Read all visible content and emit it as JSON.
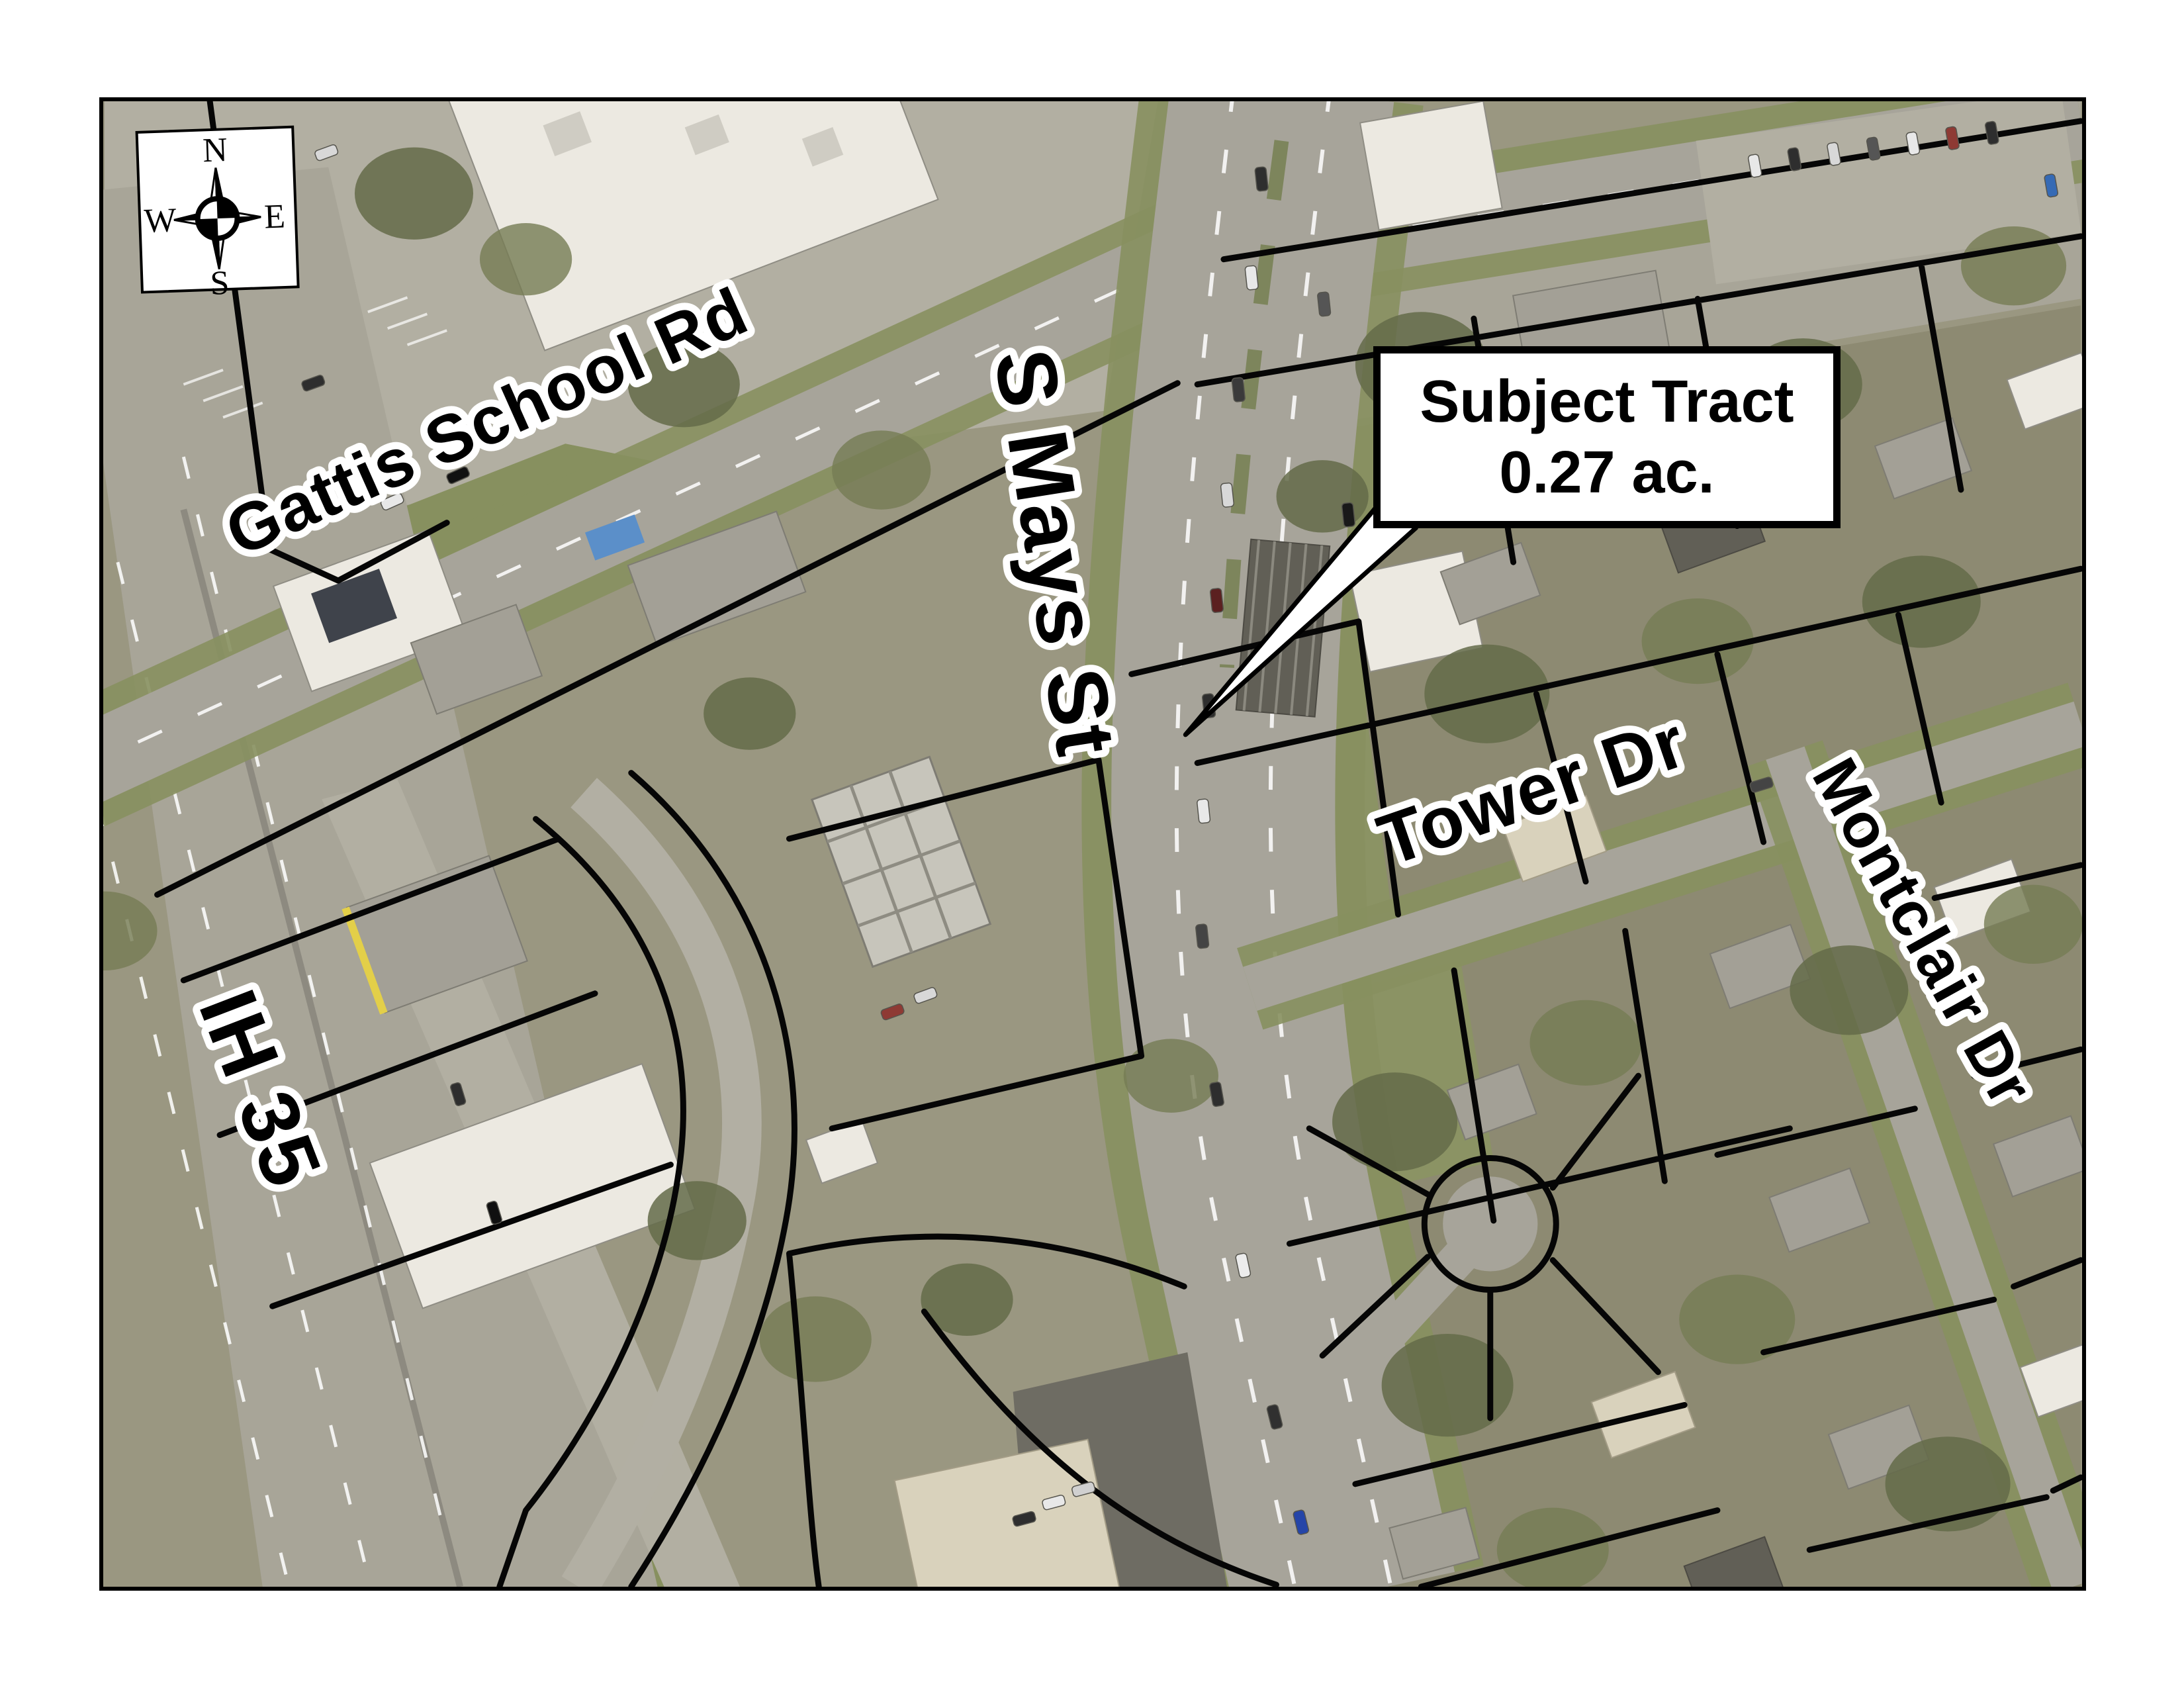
{
  "map": {
    "compass": {
      "n": "N",
      "e": "E",
      "s": "S",
      "w": "W"
    },
    "street_labels": {
      "gattis_school_rd": "Gattis School Rd",
      "s_mays_st": "S Mays St",
      "ih_35": "IH 35",
      "tower_dr": "Tower Dr",
      "montclair_dr": "Montclair Dr"
    },
    "callout": {
      "title": "Subject Tract",
      "area": "0.27 ac."
    }
  },
  "colors": {
    "page_bg": "#ffffff",
    "map_border": "#000000",
    "ground": "#9a9781",
    "pavement": "#b2afa2",
    "pavement2": "#a8a598",
    "residential": "#8d8a72",
    "grass": "#87905f",
    "tract_grass": "#8b9364",
    "tree": "#646b49",
    "tree2": "#757c54",
    "road": "#a7a49a",
    "building_light": "#ece9e1",
    "building_gray": "#a3a096",
    "parcel_line": "#060606",
    "label_fill": "#000000",
    "label_halo": "#ffffff",
    "callout_bg": "#ffffff",
    "callout_border": "#000000"
  }
}
